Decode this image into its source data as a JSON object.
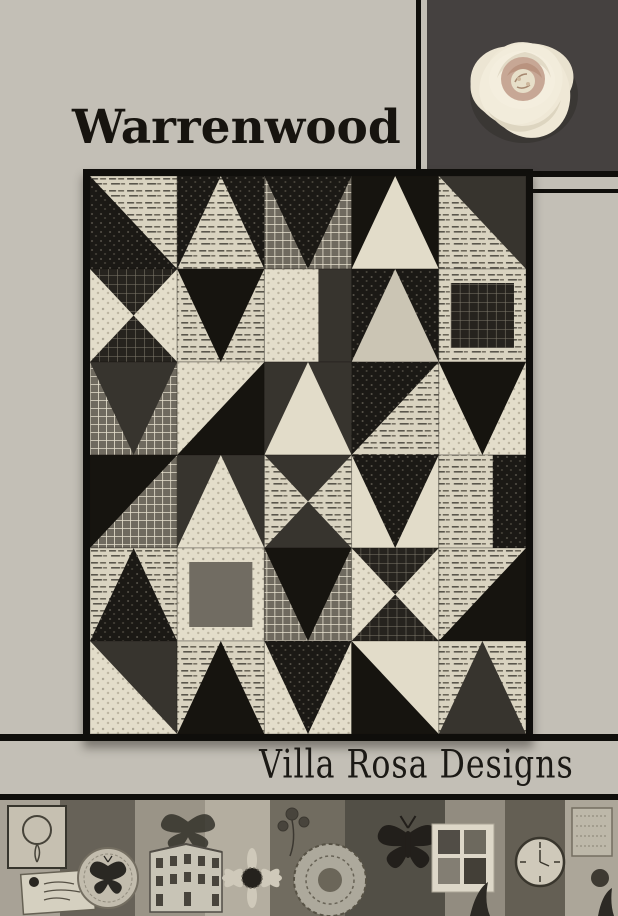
{
  "page": {
    "background": "#c3bfb6",
    "title": "Warrenwood",
    "brand": "Villa Rosa Designs"
  },
  "colors": {
    "accent_black": "#0f0e0b",
    "rose_panel_bg": "#454140",
    "rose_cream": "#efe8d6",
    "rose_center": "#c7a795",
    "quilt_border": "#100f0c"
  },
  "quilt": {
    "grid": {
      "cols": 5,
      "rows": 6,
      "cell_w": 87,
      "cell_h": 93
    },
    "palette": [
      "#16140f",
      "url(#pSpeck)",
      "#37342e",
      "url(#pDarkGrid)",
      "#716c62",
      "url(#pGrid)",
      "url(#pText)",
      "#cbc5b4",
      "url(#pCream)",
      "#e2dcc9",
      "#8e897d"
    ],
    "cells": [
      [
        "hs",
        3,
        1,
        6
      ],
      [
        "tri",
        0,
        6,
        1
      ],
      [
        "tri",
        2,
        1,
        5
      ],
      [
        "tri",
        0,
        9,
        0
      ],
      [
        "hs",
        1,
        2,
        6
      ],
      [
        "hg",
        0,
        3,
        8
      ],
      [
        "tri",
        2,
        0,
        6
      ],
      [
        "bars",
        0,
        8,
        2
      ],
      [
        "tri",
        0,
        7,
        1
      ],
      [
        "pl",
        0,
        6,
        3
      ],
      [
        "tri",
        2,
        2,
        5
      ],
      [
        "hs",
        2,
        0,
        8
      ],
      [
        "tri",
        0,
        9,
        2
      ],
      [
        "hs",
        0,
        1,
        6
      ],
      [
        "tri",
        2,
        0,
        8
      ],
      [
        "hs",
        0,
        0,
        5
      ],
      [
        "tri",
        0,
        8,
        2
      ],
      [
        "hg",
        0,
        2,
        6
      ],
      [
        "tri",
        2,
        1,
        9
      ],
      [
        "bars",
        0,
        6,
        1
      ],
      [
        "tri",
        0,
        1,
        6
      ],
      [
        "pl",
        0,
        8,
        4
      ],
      [
        "tri",
        2,
        0,
        5
      ],
      [
        "hg",
        0,
        3,
        8
      ],
      [
        "hs",
        2,
        0,
        6
      ],
      [
        "hs",
        1,
        2,
        8
      ],
      [
        "tri",
        0,
        0,
        6
      ],
      [
        "tri",
        2,
        1,
        8
      ],
      [
        "hs",
        3,
        0,
        9
      ],
      [
        "tri",
        0,
        2,
        6
      ]
    ]
  }
}
